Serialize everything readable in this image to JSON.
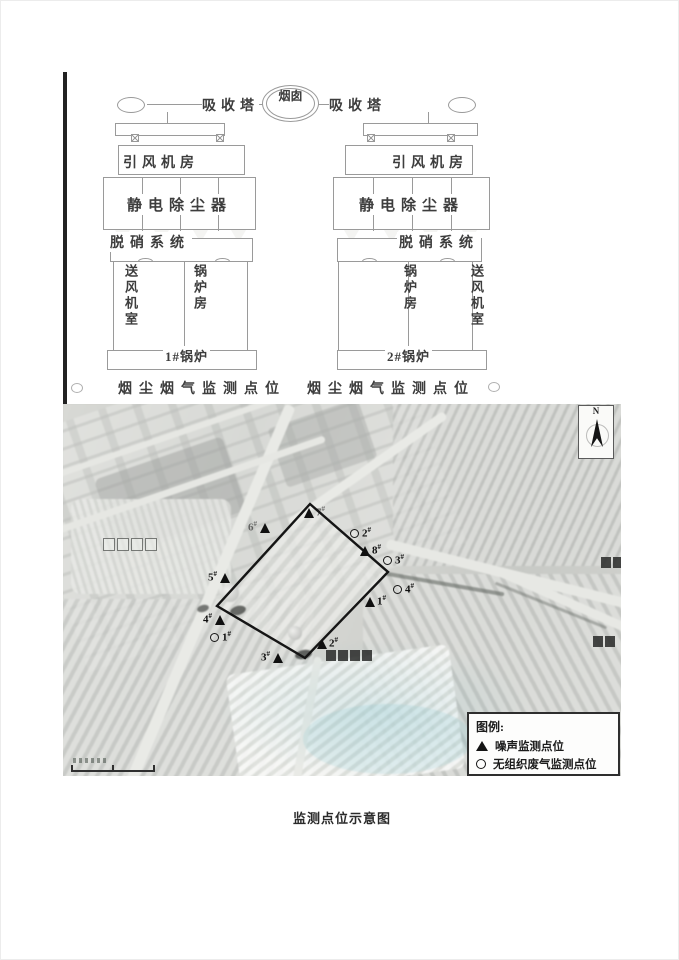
{
  "diagram": {
    "chimney_label": "烟囱",
    "absorber_left": "吸收塔",
    "absorber_right": "吸收塔",
    "units": [
      {
        "fan_room": "引风机房",
        "esp": "静电除尘器",
        "denox": "脱硝系统",
        "air_room": "送风机室",
        "boiler_room": "锅炉房",
        "boiler_id": "1#锅炉"
      },
      {
        "fan_room": "引风机房",
        "esp": "静电除尘器",
        "denox": "脱硝系统",
        "air_room": "送风机室",
        "boiler_room": "锅炉房",
        "boiler_id": "2#锅炉"
      }
    ],
    "flue_caption_left": "烟尘烟气监测点位",
    "flue_caption_right": "烟尘烟气监测点位"
  },
  "map": {
    "north_label": "N",
    "legend": {
      "title": "图例:",
      "items": [
        {
          "symbol": "triangle",
          "label": "噪声监测点位"
        },
        {
          "symbol": "circle",
          "label": "无组织废气监测点位"
        }
      ]
    },
    "boundary": [
      [
        247,
        100
      ],
      [
        325,
        168
      ],
      [
        242,
        254
      ],
      [
        154,
        202
      ]
    ],
    "noise_points": [
      {
        "label": "1#",
        "x": 307,
        "y": 198,
        "side": "right"
      },
      {
        "label": "2#",
        "x": 259,
        "y": 240,
        "side": "right"
      },
      {
        "label": "3#",
        "x": 215,
        "y": 254,
        "side": "left"
      },
      {
        "label": "4#",
        "x": 157,
        "y": 216,
        "side": "left"
      },
      {
        "label": "5#",
        "x": 162,
        "y": 174,
        "side": "left"
      },
      {
        "label": "6#",
        "x": 202,
        "y": 124,
        "side": "left",
        "muted": true
      },
      {
        "label": "7#",
        "x": 246,
        "y": 109,
        "side": "right",
        "muted": true
      },
      {
        "label": "8#",
        "x": 302,
        "y": 147,
        "side": "right"
      }
    ],
    "gas_points": [
      {
        "label": "1#",
        "x": 152,
        "y": 234,
        "side": "right"
      },
      {
        "label": "2#",
        "x": 292,
        "y": 130,
        "side": "right"
      },
      {
        "label": "3#",
        "x": 325,
        "y": 157,
        "side": "right"
      },
      {
        "label": "4#",
        "x": 335,
        "y": 186,
        "side": "right"
      }
    ]
  },
  "caption": "监测点位示意图",
  "colors": {
    "boundary": "#151515",
    "marker": "#101010",
    "diagram_line": "#9a9a9a"
  }
}
